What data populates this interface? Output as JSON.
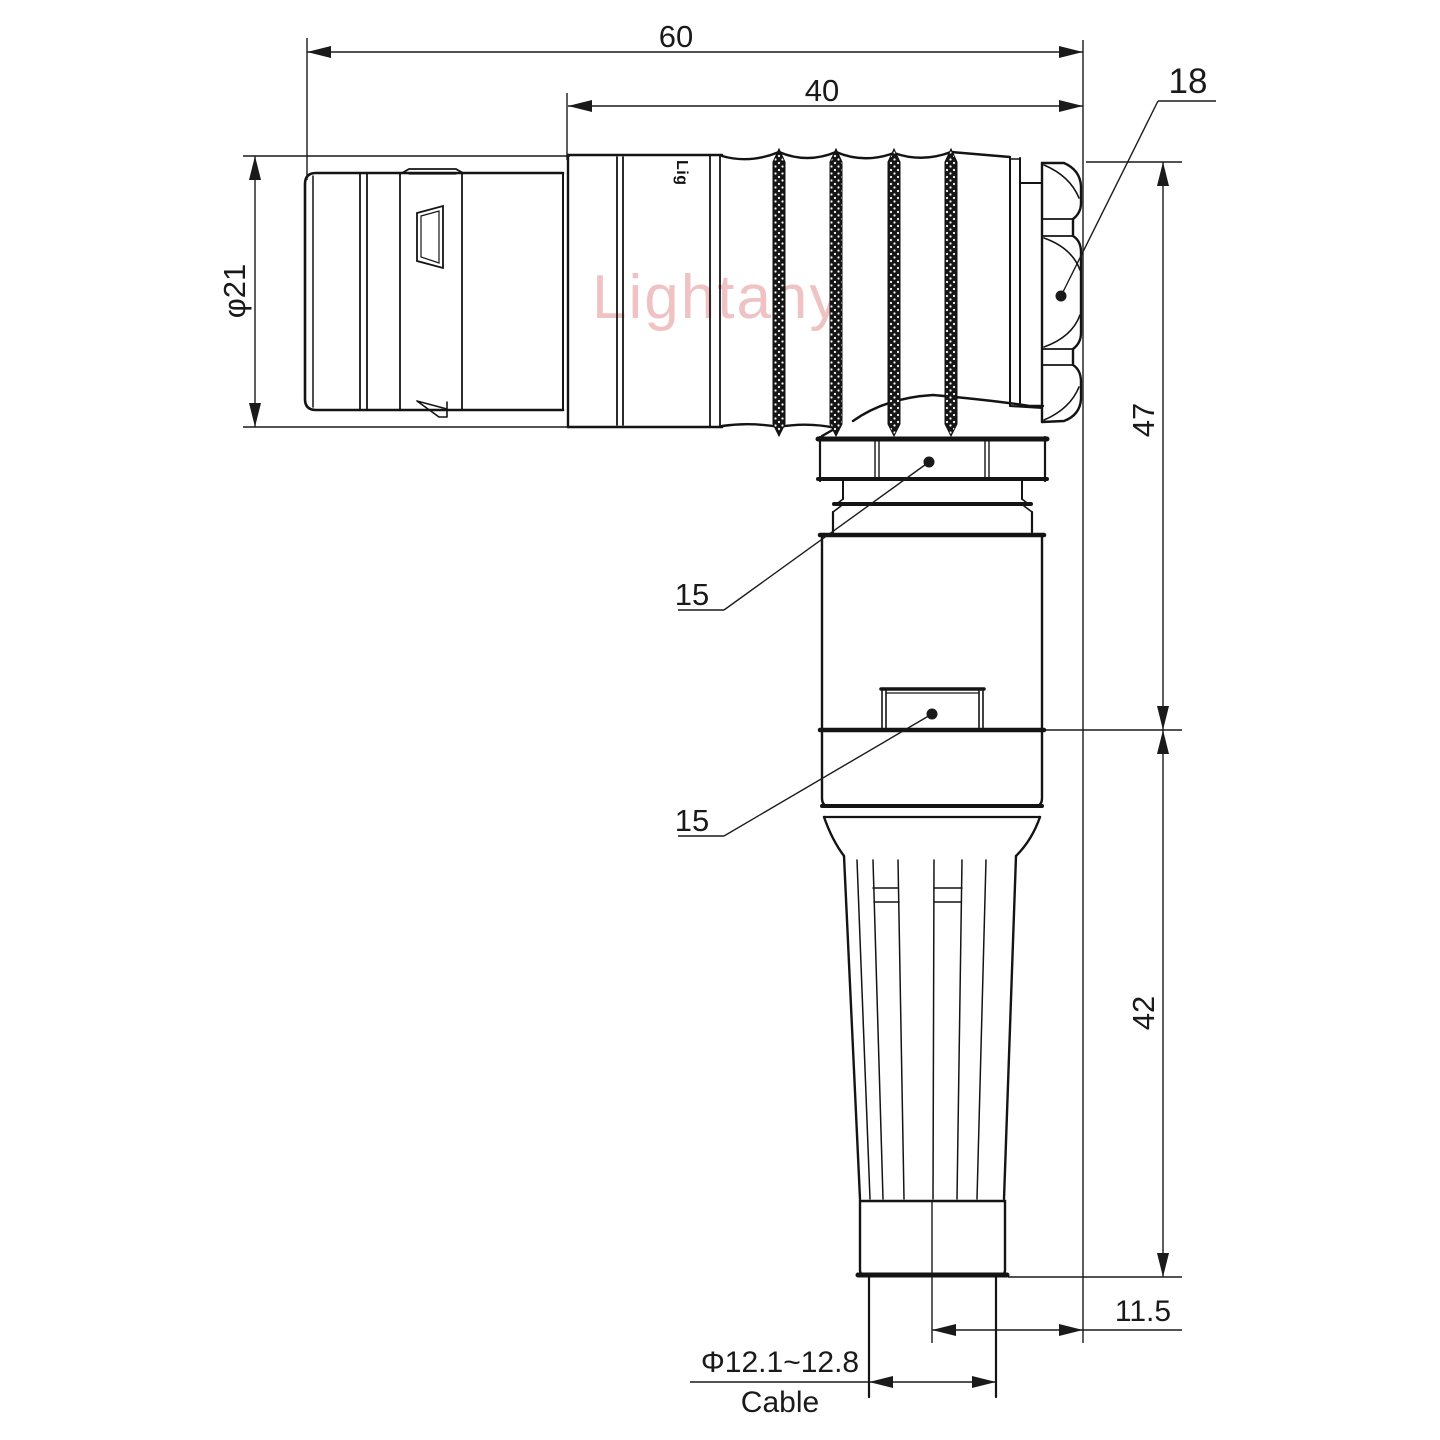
{
  "watermark": {
    "text": "Lightany",
    "color": "#edb9b9"
  },
  "connector": {
    "shell_logo": "Lig"
  },
  "dimensions": {
    "overall_length": "60",
    "rear_body_length": "40",
    "nut_across_flats": "18",
    "shell_diameter": "φ21",
    "upper_height": "47",
    "lower_height": "42",
    "cable_axis_offset": "11.5",
    "coupling_nut_hex": "15",
    "body_hex": "15",
    "cable_diameter_range": "Φ12.1~12.8",
    "cable_label": "Cable"
  },
  "colors": {
    "line": "#141414",
    "dimension_text": "#1a1a1a"
  }
}
